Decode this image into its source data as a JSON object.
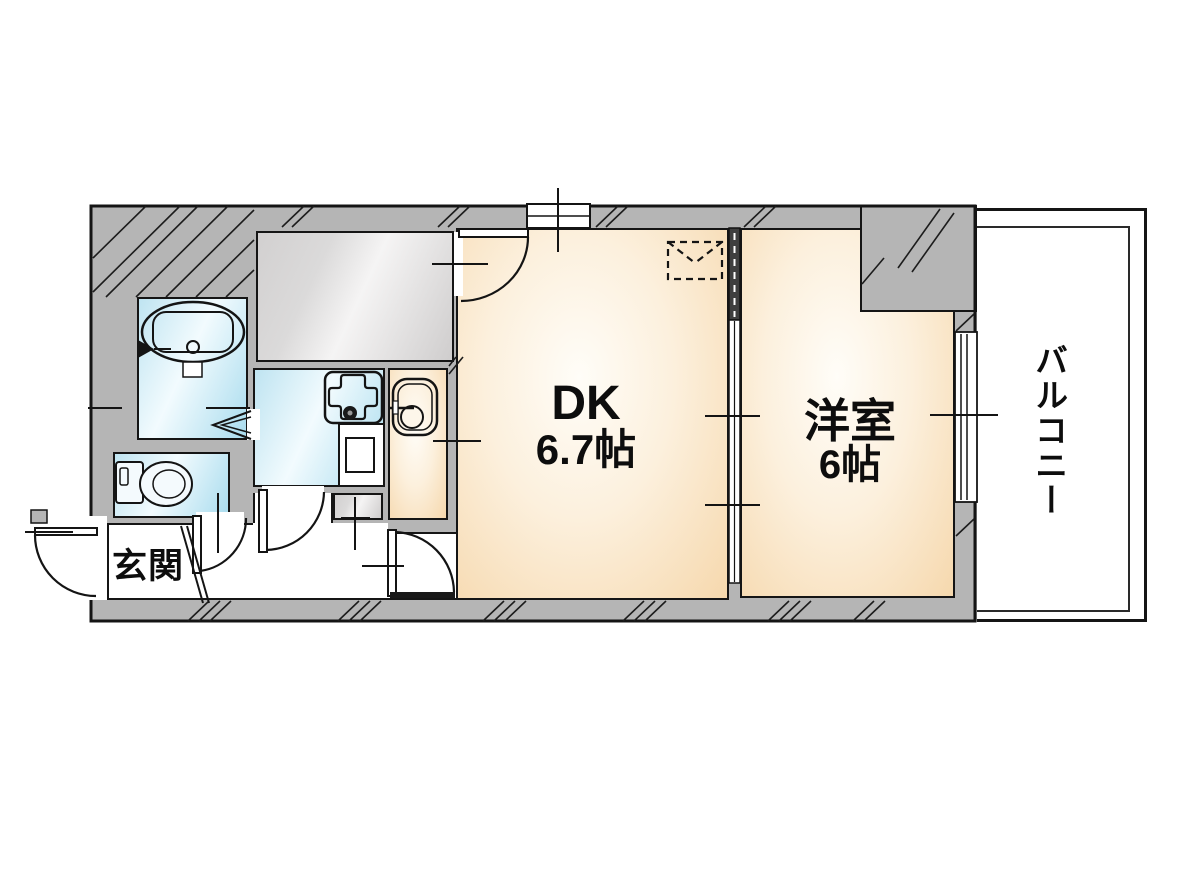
{
  "labels": {
    "dk_name": "DK",
    "dk_size": "6.7帖",
    "western_name": "洋室",
    "western_size": "6帖",
    "entrance": "玄関",
    "balcony": "バルコニー"
  },
  "colors": {
    "wall": "#b5b5b5",
    "outline": "#151515",
    "warm_floor": "#f6d8ad",
    "warm_floor_light": "#fffdf8",
    "wet_floor": "#a9dcee",
    "wet_floor_light": "#f2fbfe",
    "storage_gray": "#d2d0d0",
    "balcony_white": "#ffffff"
  },
  "inventory": {
    "labeled_rooms": [
      "dk",
      "western-room",
      "entrance",
      "balcony"
    ],
    "unlabeled_rooms": [
      "kitchen",
      "bathroom",
      "toilet",
      "hallway",
      "storage-room"
    ],
    "fixtures": [
      "bathtub",
      "shower-mixer",
      "toilet-bowl",
      "gas-burner",
      "kitchen-counter",
      "washing-machine-pan",
      "shoe-cabinet",
      "hanging-cabinet"
    ],
    "doors": [
      "entrance-swing-door",
      "storage-swing-door",
      "toilet-swing-door",
      "kitchen-swing-door",
      "dk-swing-door",
      "bathroom-folding-door",
      "dk-western-sliding-door"
    ],
    "windows": [
      "dk-top-window",
      "balcony-sliding-window"
    ]
  }
}
